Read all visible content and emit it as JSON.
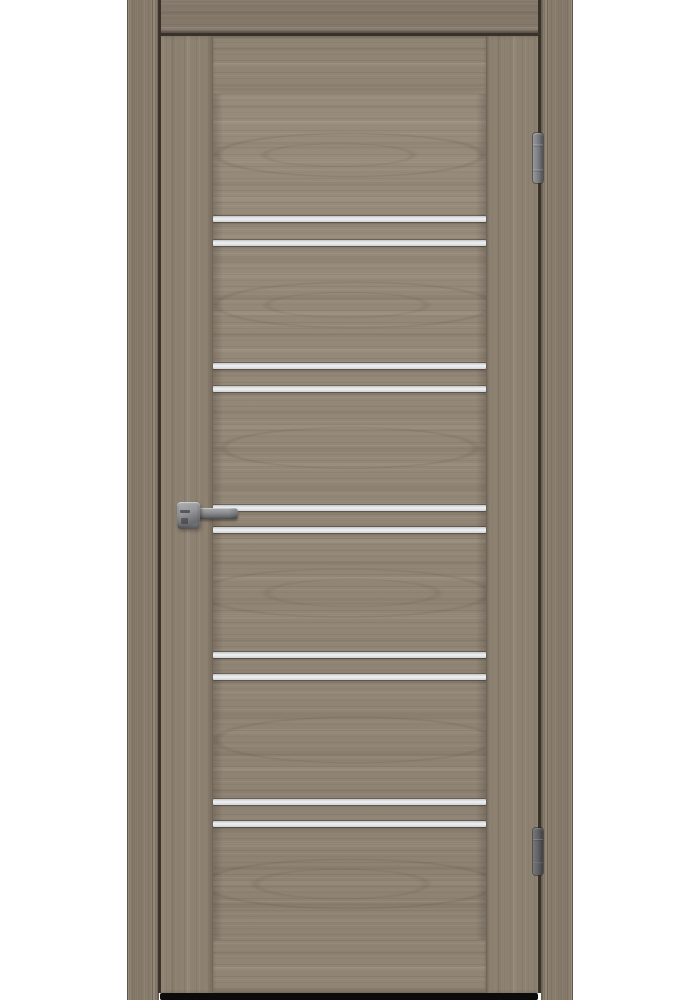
{
  "scene": {
    "type": "product-photo",
    "subject": "Closed interior door with gray oak woodgrain finish, five pairs of horizontal frosted glass stripes, lever handle on left, two hinges on right",
    "background_color": "#ffffff"
  },
  "palette": {
    "background": "#ffffff",
    "wood_panel": "#948878",
    "wood_stile": "#8d8171",
    "wood_rail": "#908474",
    "wood_casing": "#877b6b",
    "wood_head": "#83786a",
    "gap_dark": "#38322b",
    "stripe_light": "#eef0f1",
    "stripe_shade": "#c3c7ca",
    "metal_light": "#95969a",
    "metal_dark": "#4a4b50",
    "shadow_dark": "#0b0b0b"
  },
  "door": {
    "frame": {
      "outer_left_x": 127,
      "outer_right_x": 573,
      "casing_width": 32,
      "head_height": 33
    },
    "leaf": {
      "x": 160,
      "y": 36,
      "width": 378,
      "height": 957,
      "stile_width_left": 53,
      "stile_width_right": 52,
      "top_rail_height": 58,
      "bottom_rail_height": 53
    }
  },
  "glass": {
    "x": 213,
    "width": 273,
    "stripe_height": 6,
    "color": "#dfe2e4",
    "y_positions": [
      216,
      240,
      363,
      386,
      505,
      527,
      652,
      674,
      799,
      821
    ]
  },
  "hardware": {
    "handle": {
      "style": "square rosette with straight lever, metallic gray",
      "rosette": {
        "x": 177,
        "y": 502,
        "width": 23,
        "height": 27
      },
      "lever": {
        "x": 195,
        "y": 508,
        "width": 43,
        "height": 11
      }
    },
    "hinges": [
      {
        "id": "hinge-top",
        "x": 533,
        "y": 133,
        "width": 10,
        "height": 50
      },
      {
        "id": "hinge-bottom",
        "x": 533,
        "y": 828,
        "width": 10,
        "height": 47
      }
    ]
  },
  "floor_shadow": {
    "x": 160,
    "y": 993,
    "width": 378,
    "height": 7
  }
}
